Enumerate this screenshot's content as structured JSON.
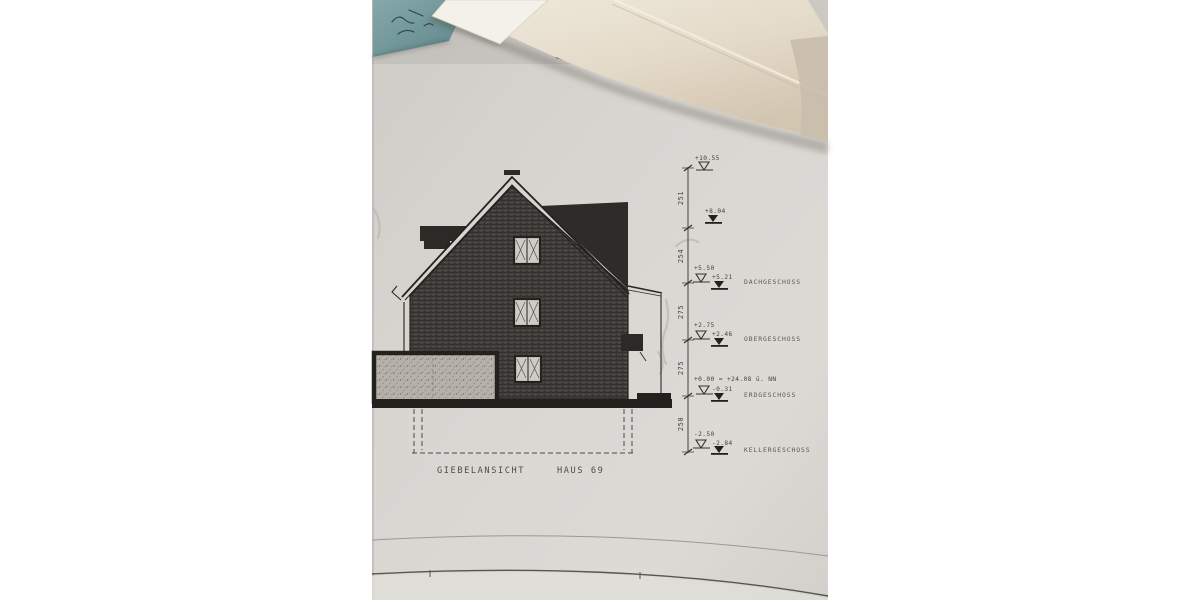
{
  "drawing": {
    "title": {
      "view_label": "GIEBELANSICHT",
      "house_label": "HAUS 69"
    },
    "levels": {
      "ridge_top": {
        "finished": "+10.55"
      },
      "ridge_raw": {
        "raw": "+8.04"
      },
      "dachgeschoss": {
        "finished": "+5.50",
        "raw": "+5.21",
        "label": "DACHGESCHOSS"
      },
      "obergeschoss": {
        "finished": "+2.75",
        "raw": "+2.46",
        "label": "OBERGESCHOSS"
      },
      "erdgeschoss": {
        "finished": "+0.00 = +24.08 ü. NN",
        "raw": "-0.31",
        "label": "ERDGESCHOSS"
      },
      "kellergeschoss": {
        "finished": "-2.50",
        "raw": "-2.84",
        "label": "KELLERGESCHOSS"
      }
    },
    "dimension_chain": {
      "segments": [
        "251",
        "254",
        "275",
        "275",
        "250"
      ]
    },
    "colors": {
      "sheet_paper": "#d7d5d0",
      "ink": "#23211e",
      "wall_hatch": "#413f3b",
      "garage_stipple": "#b6b2aa",
      "cream_paper": "#e9e2d2",
      "blue_note": "#7ba1a4",
      "table_wood": "#5a3c1c",
      "background": "#ffffff"
    }
  }
}
